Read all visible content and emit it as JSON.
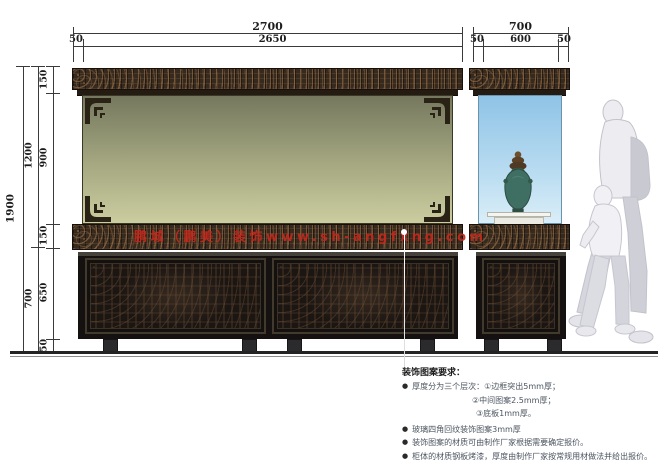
{
  "drawing": {
    "title": "display cabinet elevation drawing",
    "dims_top_main": {
      "total": "2700",
      "offset_left": "50",
      "inner": "2650"
    },
    "dims_top_side": {
      "total": "700",
      "offset_left": "50",
      "inner": "600",
      "offset_right": "50"
    },
    "dims_left": {
      "overall": "1900",
      "group_upper": "1200",
      "group_lower": "700",
      "seg_top_frieze": "150",
      "seg_glass": "900",
      "seg_mid_band": "150",
      "seg_cabinet": "650",
      "seg_feet": "50"
    },
    "watermark": "鹏城（鹏美）装饰www.sh-angfxng.com",
    "notes": {
      "title": "装饰图案要求：",
      "bullet": "●",
      "note1a": "厚度分为三个层次：①边框突出5mm厚；",
      "note1b": "②中间图案2.5mm厚；",
      "note1c": "③底板1mm厚。",
      "note2": "玻璃四角回纹装饰图案3mm厚",
      "note3": "装饰图案的材质可由制作厂家根据需要确定报价。",
      "note4": "柜体的材质钢板烤漆，厚度由制作厂家按常规用材做法并给出报价。"
    },
    "colors": {
      "frieze_wood": "#36291d",
      "panel_wood": "#1c1613",
      "glass_main_top": "#75785e",
      "glass_main_bottom": "#cbcda0",
      "glass_side_top": "#8fc3e6",
      "glass_side_bottom": "#daeef8",
      "watermark_red": "#c4281c",
      "dimension_line": "#3a3a3a",
      "note_text": "#4c5660"
    }
  }
}
